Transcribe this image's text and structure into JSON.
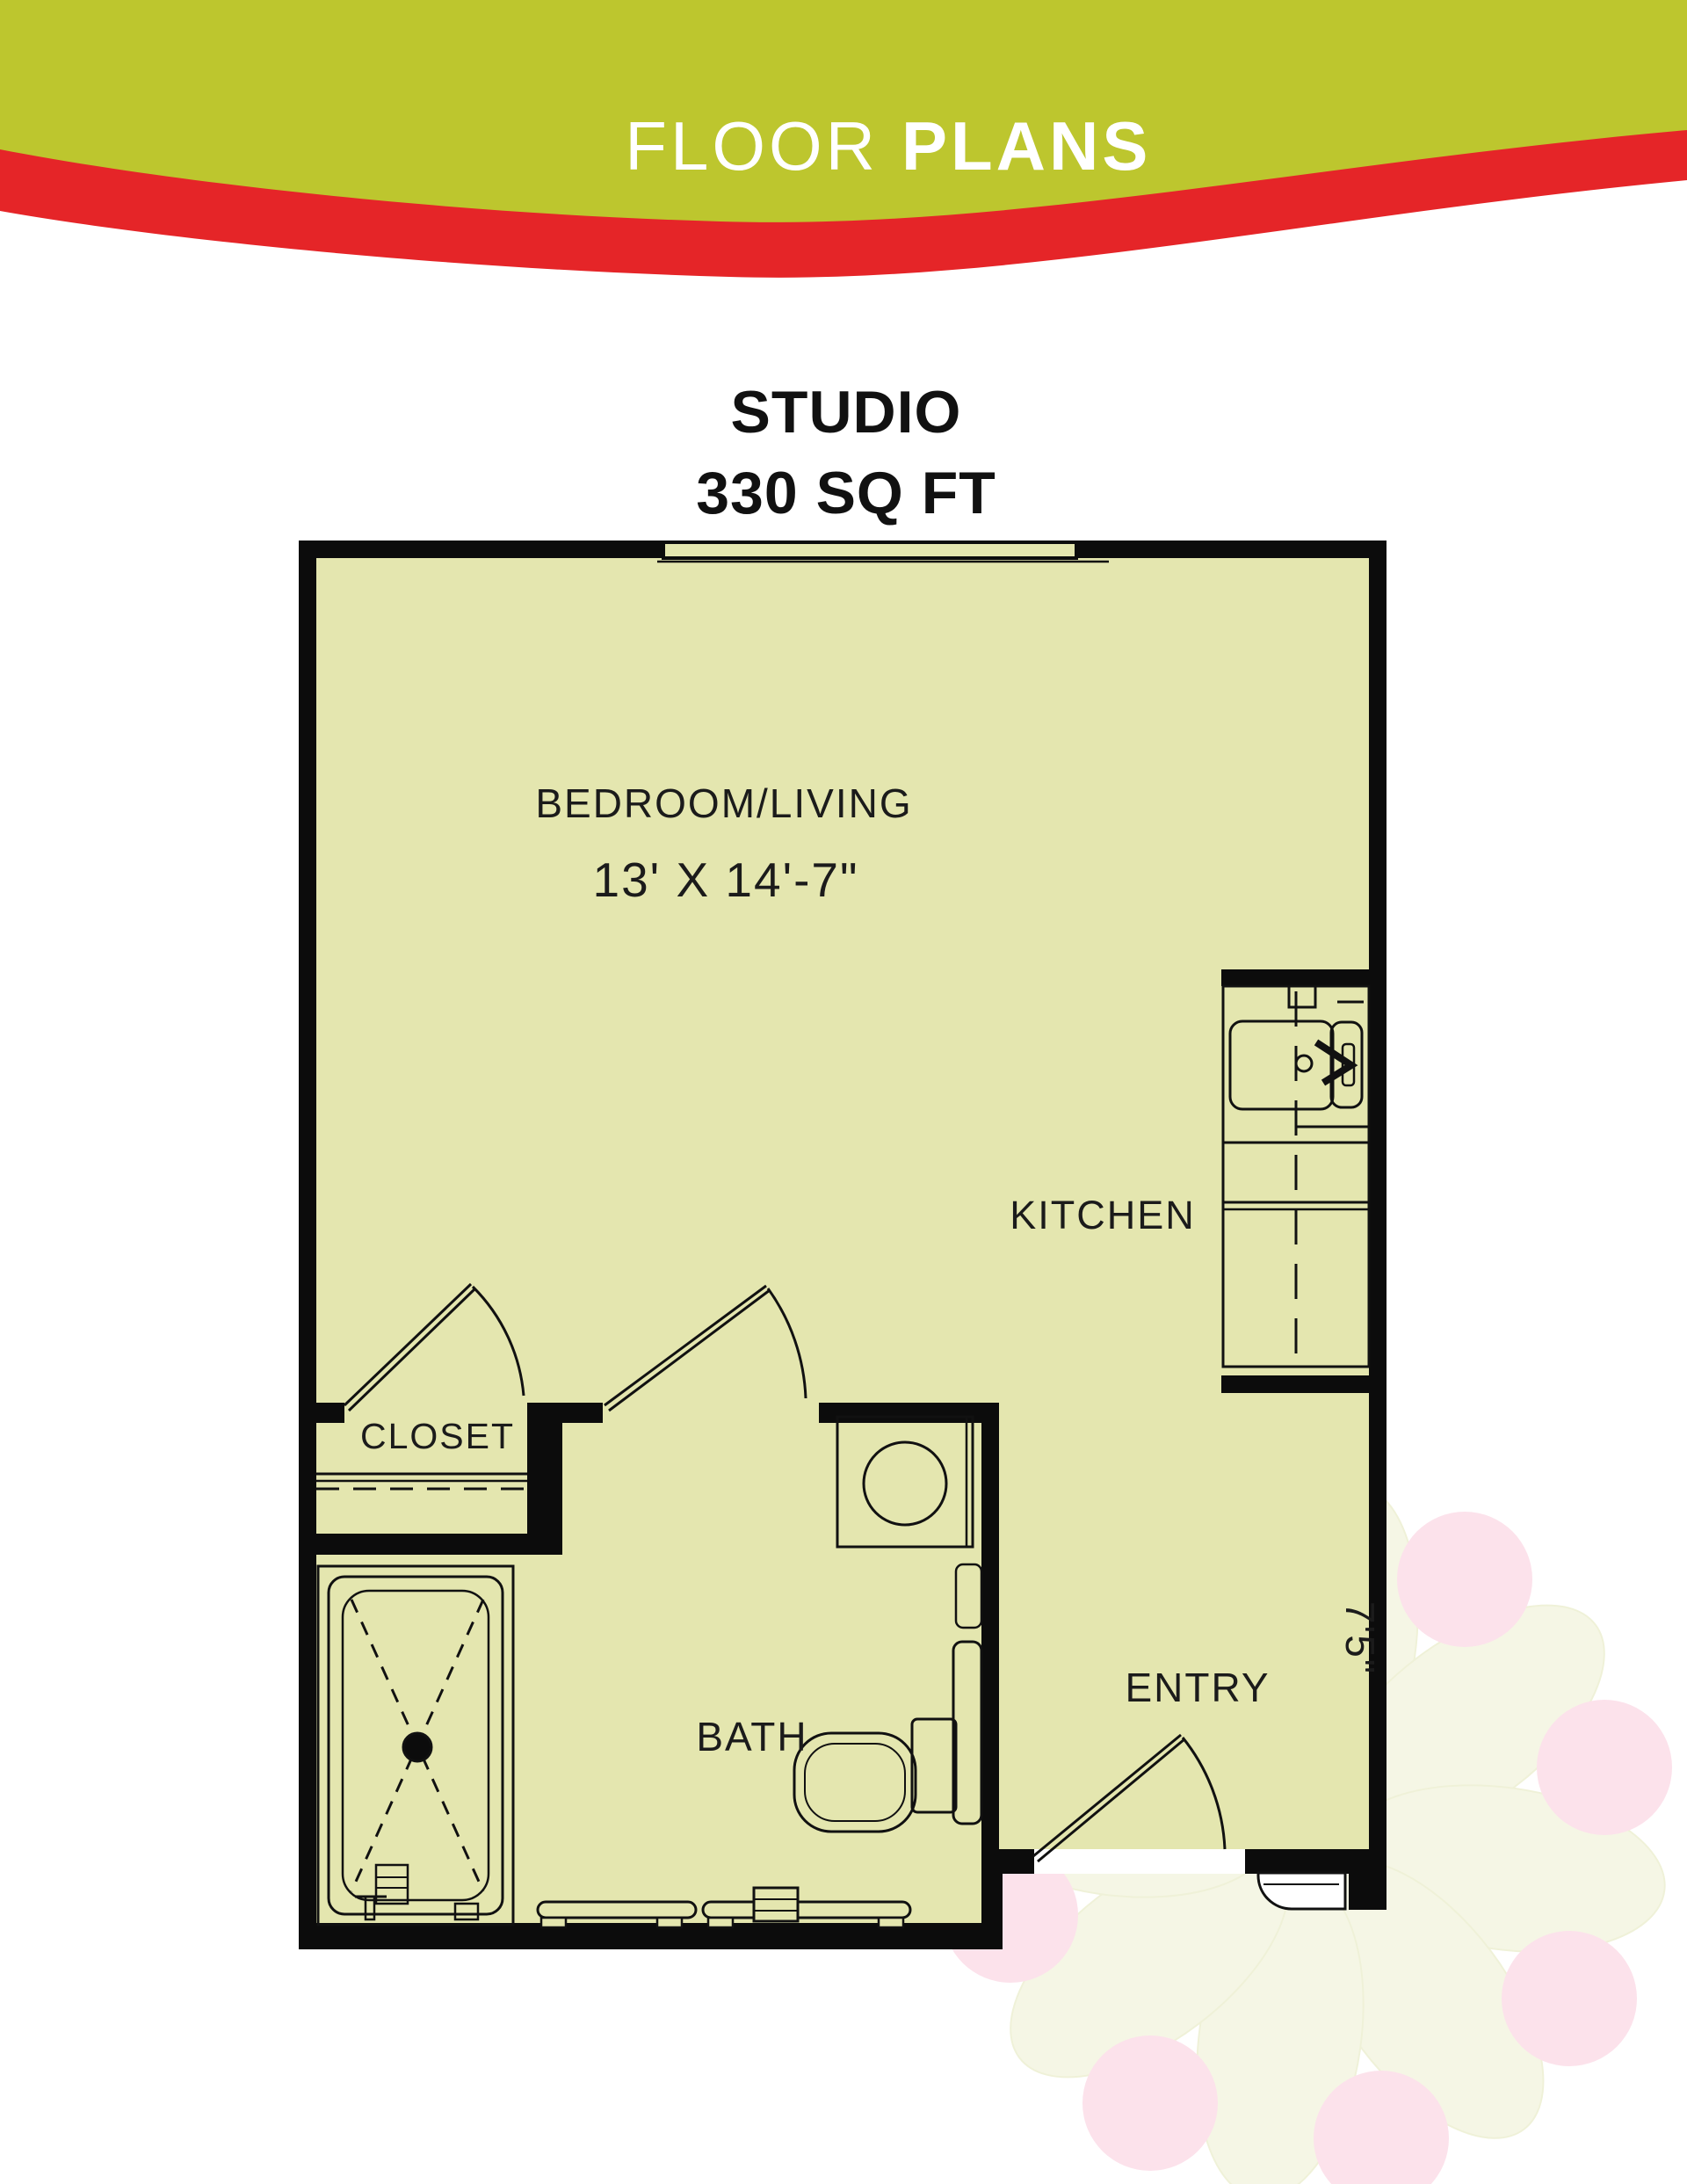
{
  "header": {
    "title_light": "FLOOR",
    "title_bold": "PLANS",
    "banner_color": "#bdc62e",
    "ribbon_color": "#e52528",
    "text_color": "#ffffff"
  },
  "plan_title": {
    "line1": "STUDIO",
    "line2": "330 SQ FT"
  },
  "floor_plan": {
    "floor_color": "#e4e6af",
    "wall_color": "#0c0c0c",
    "label_color": "#1b1b1b",
    "rooms": [
      {
        "id": "bedroom-living",
        "label": "BEDROOM/LIVING",
        "dimensions": "13' X 14'-7\""
      },
      {
        "id": "kitchen",
        "label": "KITCHEN"
      },
      {
        "id": "closet",
        "label": "CLOSET"
      },
      {
        "id": "bath",
        "label": "BATH"
      },
      {
        "id": "entry",
        "label": "ENTRY",
        "dimension": "7'5\""
      }
    ],
    "fixture_icons": [
      "window-icon",
      "kitchen-sink-icon",
      "washer-dryer-icon",
      "toilet-icon",
      "vanity-icon",
      "shower-icon",
      "shower-drain-icon",
      "grab-bar-icon",
      "door-swing-icon",
      "entry-threshold-icon"
    ]
  },
  "watermark": {
    "petal_color": "#f5f6e3",
    "dot_color": "#fcdfe9"
  }
}
